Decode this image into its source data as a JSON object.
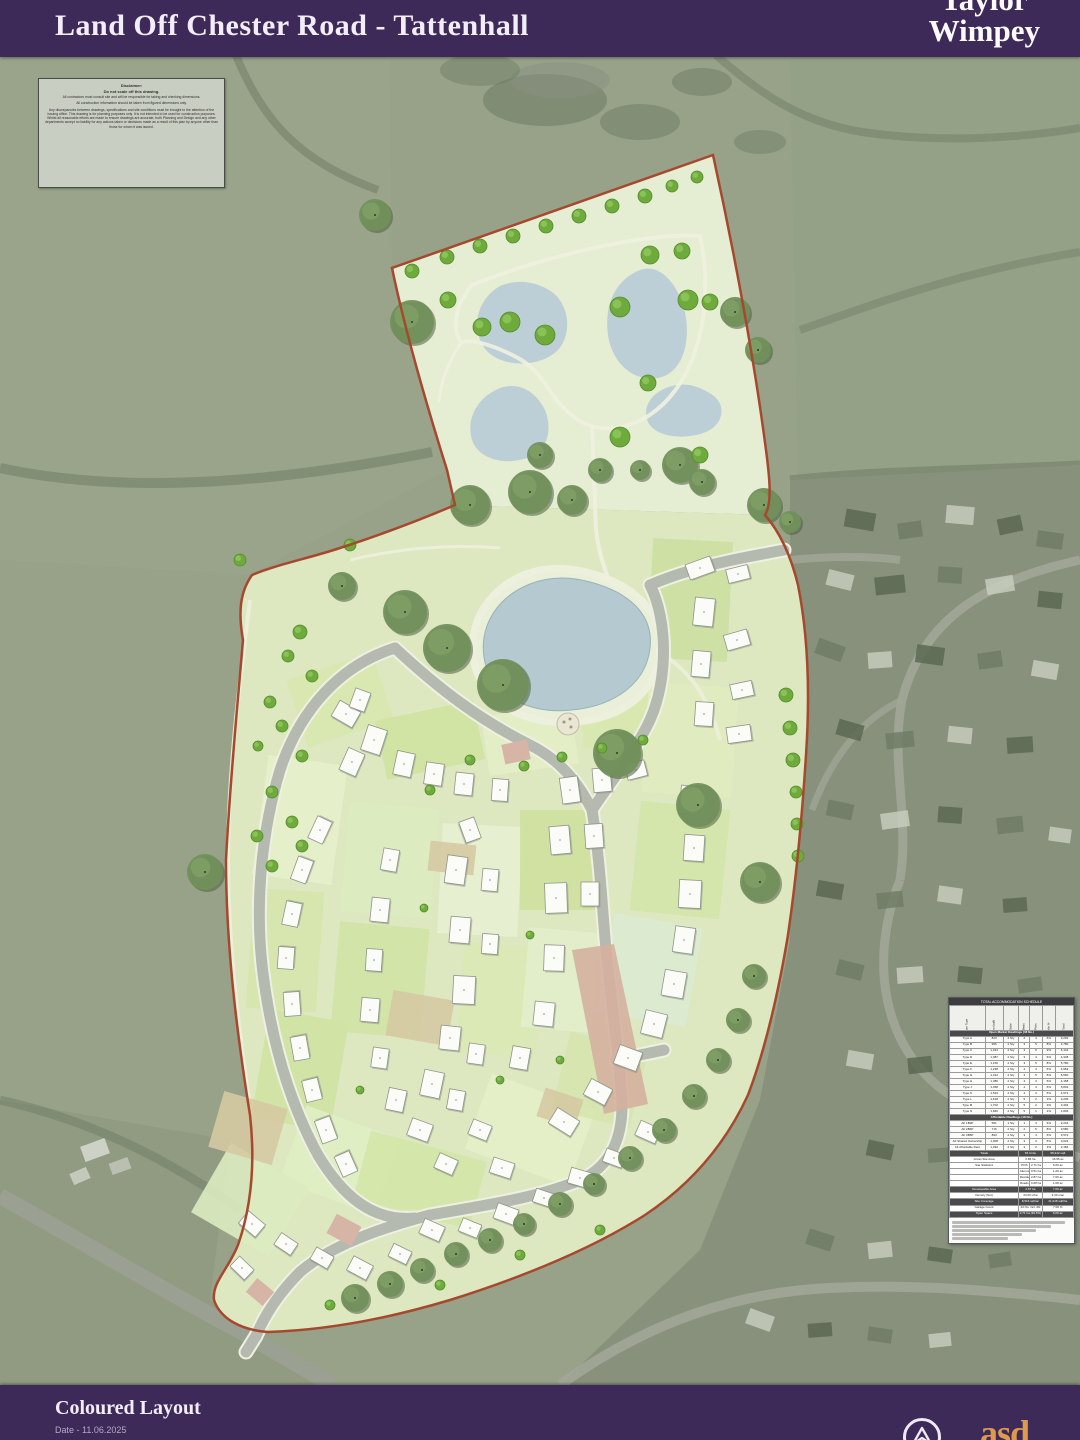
{
  "header": {
    "title": "Land Off Chester Road - Tattenhall",
    "logo_line1": "Taylor",
    "logo_line2": "Wimpey"
  },
  "disclaimer": {
    "title": "Disclaimer:",
    "subtitle": "Do not scale off this drawing.",
    "paragraphs": [
      "All contractors must consult site and will be responsible for taking and checking dimensions.",
      "All construction information should be taken from figured dimensions only.",
      "Any discrepancies between drawings, specifications and site conditions must be brought to the attention of the issuing office. This drawing is for planning purposes only. It is not intended to be used for construction purposes. Whilst all reasonable efforts are made to ensure drawings are accurate, both Planning and Design and any other departments accept no liability for any actions taken or decisions made as a result of this plan by anyone other than those for whom it was issued."
    ]
  },
  "schedule": {
    "title": "TOTAL ACCOMMODATION SCHEDULE",
    "columns": [
      "House Type",
      "Area (sqft)",
      "Style",
      "Beds",
      "Plots",
      "Mix %",
      "Total"
    ],
    "sections": [
      {
        "label": "Open Market Dwellings (48 No.)",
        "rows": [
          [
            "Type A",
            "823",
            "2 Sty",
            "2",
            "4",
            "6%",
            "3,292"
          ],
          [
            "Type B",
            "956",
            "2 Sty",
            "3",
            "5",
            "8%",
            "4,780"
          ],
          [
            "Type C",
            "1,024",
            "2 Sty",
            "3",
            "6",
            "9%",
            "6,144"
          ],
          [
            "Type D",
            "1,087",
            "2 Sty",
            "3",
            "4",
            "6%",
            "4,348"
          ],
          [
            "Type E",
            "1,156",
            "2 Sty",
            "3",
            "5",
            "8%",
            "5,780"
          ],
          [
            "Type F",
            "1,238",
            "2 Sty",
            "4",
            "4",
            "6%",
            "4,952"
          ],
          [
            "Type G",
            "1,312",
            "2 Sty",
            "4",
            "5",
            "8%",
            "6,560"
          ],
          [
            "Type H",
            "1,386",
            "2 Sty",
            "4",
            "3",
            "5%",
            "4,158"
          ],
          [
            "Type J",
            "1,458",
            "2 Sty",
            "4",
            "4",
            "6%",
            "5,832"
          ],
          [
            "Type K",
            "1,524",
            "2 Sty",
            "4",
            "3",
            "5%",
            "4,572"
          ],
          [
            "Type L",
            "1,618",
            "2 Sty",
            "5",
            "2",
            "3%",
            "3,236"
          ],
          [
            "Type M",
            "1,702",
            "2 Sty",
            "5",
            "2",
            "3%",
            "3,404"
          ],
          [
            "Type N",
            "1,846",
            "2 Sty",
            "5",
            "1",
            "2%",
            "1,846"
          ]
        ]
      },
      {
        "label": "Affordable Dwellings (18 No.)",
        "rows": [
          [
            "AF 1B2P",
            "561",
            "1 Sty",
            "1",
            "4",
            "6%",
            "2,244"
          ],
          [
            "AF 2B4P",
            "716",
            "2 Sty",
            "2",
            "5",
            "8%",
            "3,580"
          ],
          [
            "AF 3B5P",
            "893",
            "2 Sty",
            "3",
            "4",
            "6%",
            "3,572"
          ],
          [
            "AF Shared Ownership",
            "1,008",
            "2 Sty",
            "3",
            "3",
            "5%",
            "3,024"
          ],
          [
            "AF Affordable Rent",
            "1,092",
            "2 Sty",
            "3",
            "2",
            "3%",
            "2,184"
          ]
        ]
      }
    ],
    "summaries": [
      {
        "label": "Totals",
        "v1": "66 Units",
        "v2": "68,342 sqft",
        "dark": true
      },
      {
        "label": "Gross Site Area",
        "v1": "6.86 ha",
        "v2": "16.95 ac",
        "dark": false
      },
      {
        "label": "Site Statistics",
        "rows": [
          [
            "POS",
            "2.71 ha",
            "6.69 ac"
          ],
          [
            "Attenuation",
            "0.51 ha",
            "1.26 ac"
          ],
          [
            "Residential Area",
            "2.87 ha",
            "7.09 ac"
          ],
          [
            "Roads",
            "0.68 ha",
            "1.68 ac"
          ]
        ]
      },
      {
        "label": "Developable Area",
        "v1": "2.87 ha",
        "v2": "7.09 ac",
        "dark": true
      },
      {
        "label": "Density (Net)",
        "v1": "23.00 u/ha",
        "v2": "9.30 u/ac",
        "dark": false
      },
      {
        "label": "Site Coverage",
        "v1": "8,516 sqft/ac",
        "v2": "21,048 sqft/ha",
        "dark": true
      },
      {
        "label": "Garage Count",
        "v1": "44 No. incl. dbl",
        "v2": "7.00 %",
        "dark": false
      },
      {
        "label": "Open Space",
        "v1": "2.71 ha (39.5%)",
        "v2": "6.69 ac",
        "dark": true
      }
    ],
    "notes_line_count": 5
  },
  "footer": {
    "drawing_title": "Coloured Layout",
    "date_label": "Date - 11.06.2025",
    "consultant_logo_text": "asd"
  },
  "colors": {
    "brand_purple": "#3e2a58",
    "boundary_red": "#a6482e",
    "pond_blue": "#b5c9d0",
    "open_space_green": "#e5edd2",
    "plot_green": "#dde8c1",
    "aerial_field": "#97a289",
    "logo_orange": "#dd9a4d"
  }
}
